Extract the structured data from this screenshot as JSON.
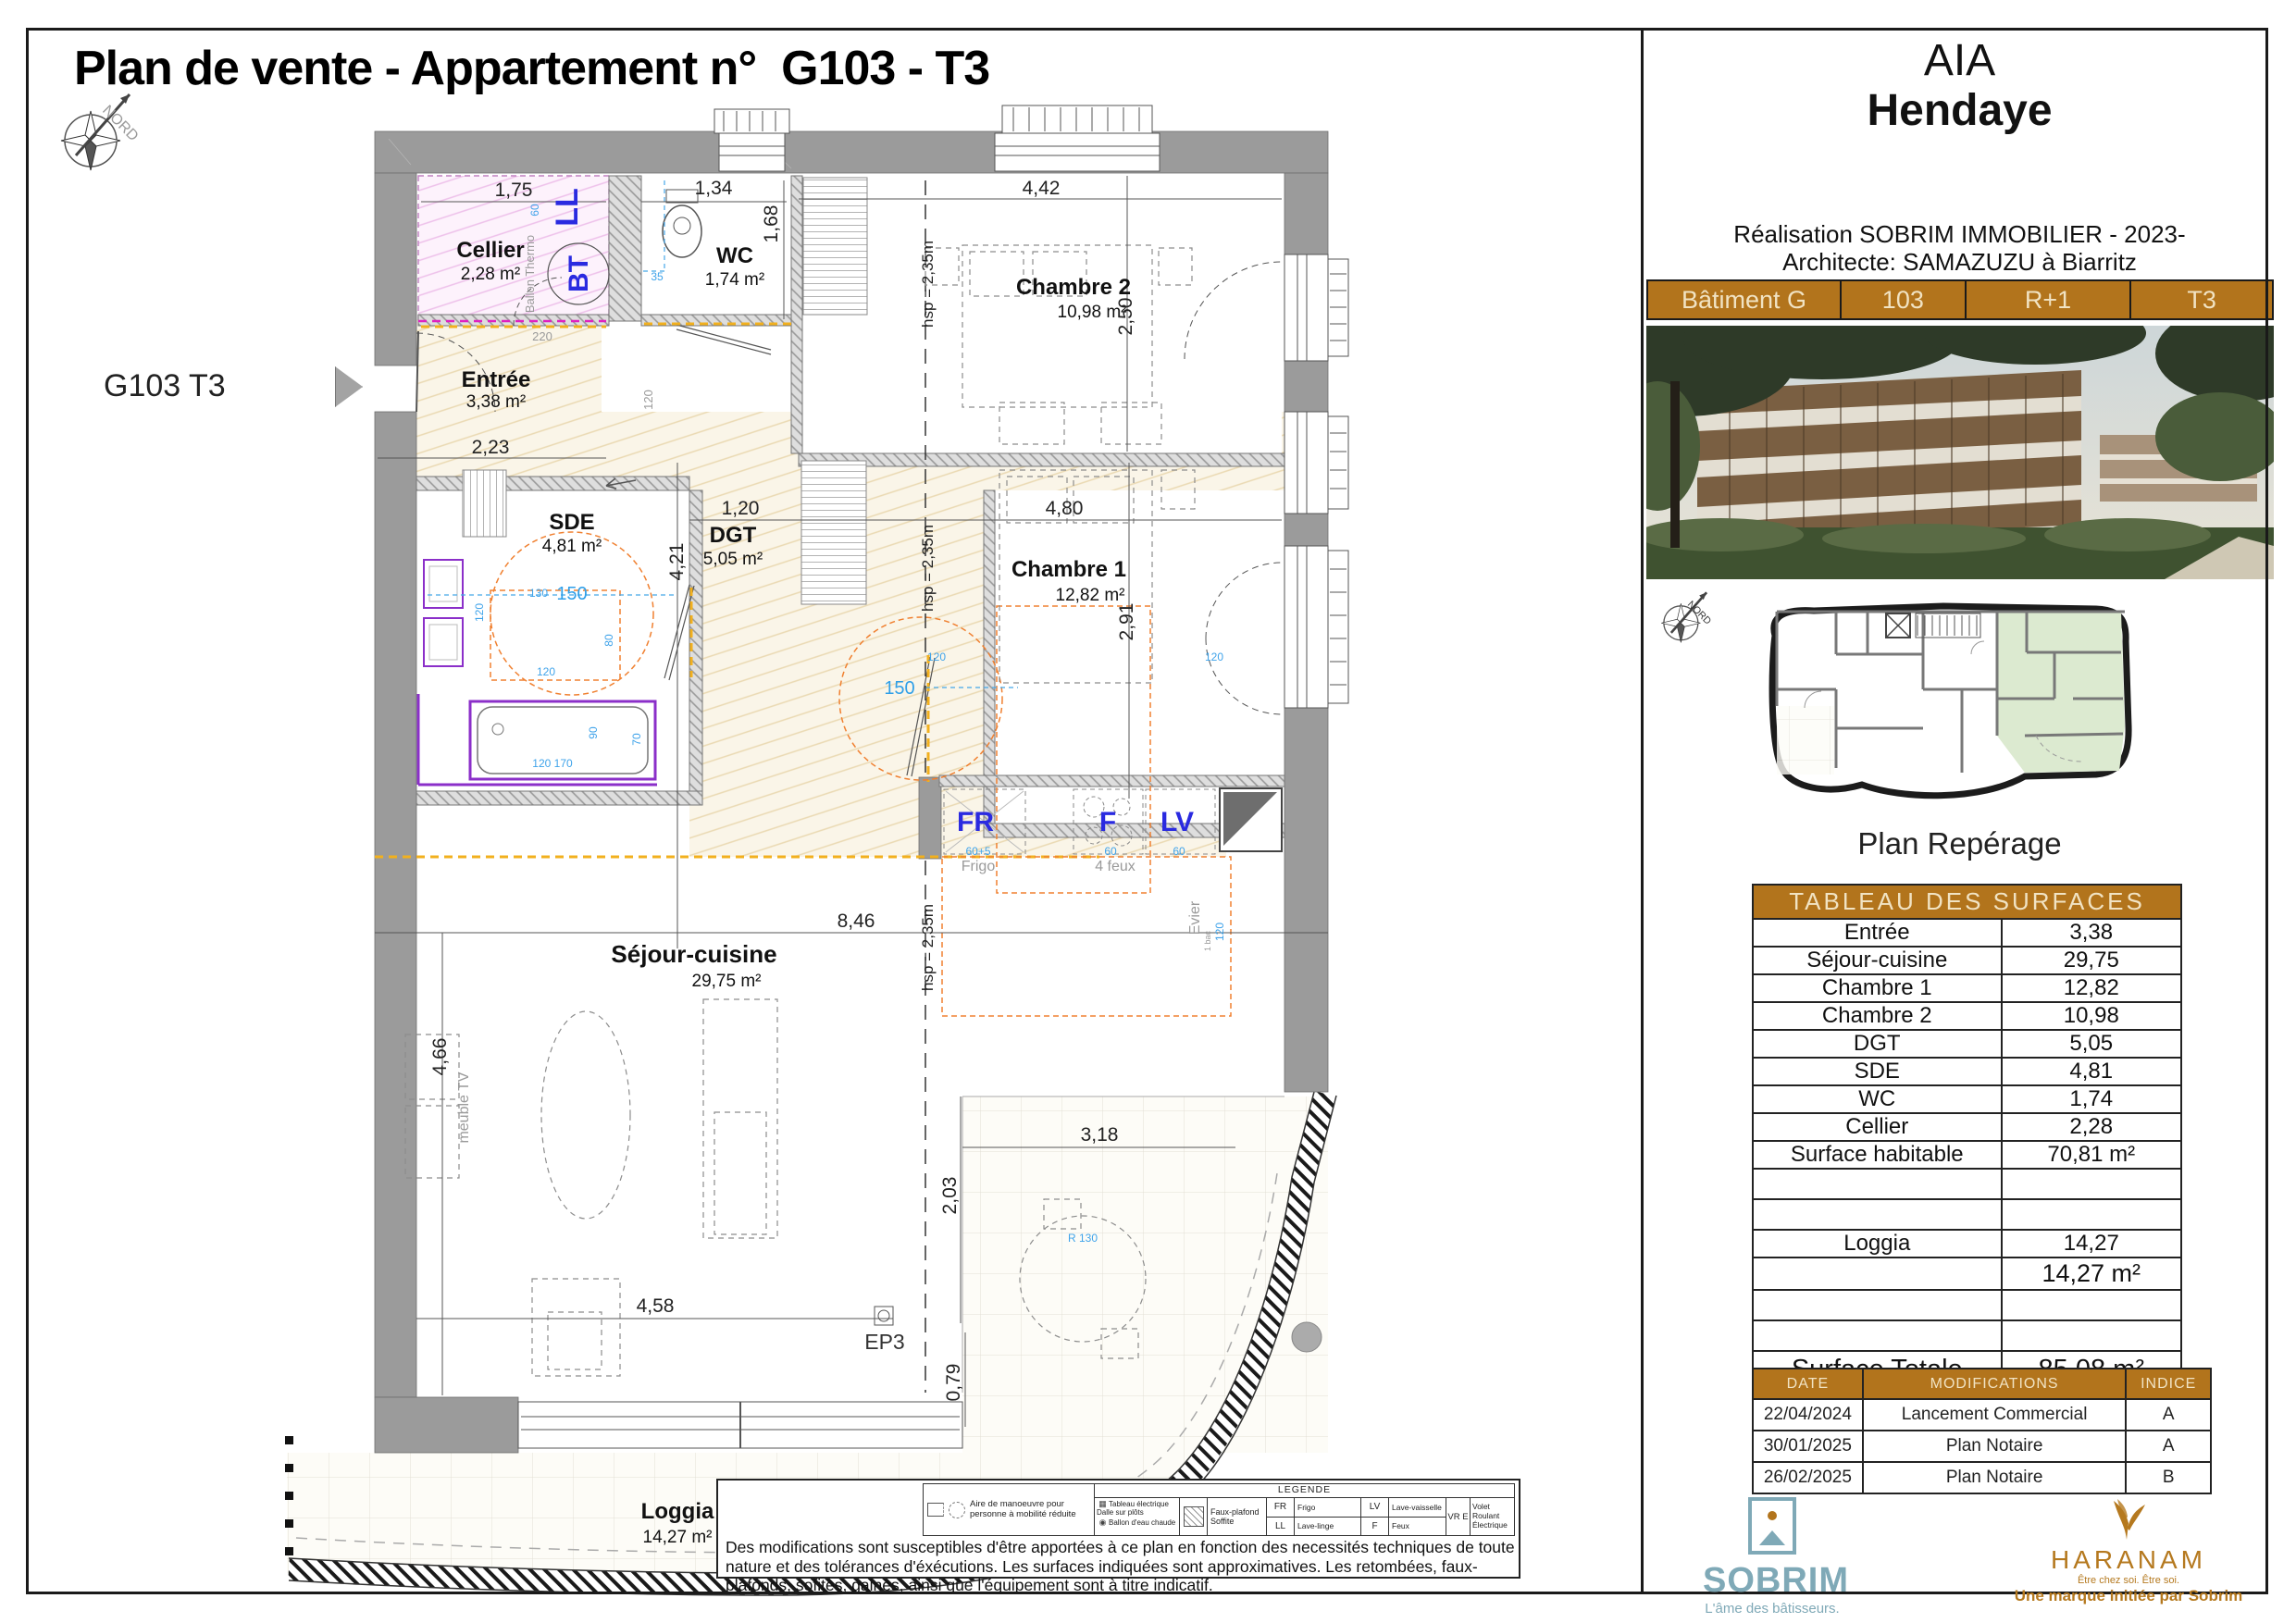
{
  "page": {
    "title": "Plan de vente - Appartement n°  G103 - T3",
    "unit_label": "G103 T3",
    "compass_label": "NORD"
  },
  "plan": {
    "rooms": {
      "cellier": {
        "name": "Cellier",
        "area": "2,28 m²"
      },
      "entree": {
        "name": "Entrée",
        "area": "3,38 m²"
      },
      "wc": {
        "name": "WC",
        "area": "1,74 m²"
      },
      "chambre2": {
        "name": "Chambre 2",
        "area": "10,98 m²"
      },
      "sde": {
        "name": "SDE",
        "area": "4,81 m²"
      },
      "dgt": {
        "name": "DGT",
        "area": "5,05 m²"
      },
      "chambre1": {
        "name": "Chambre 1",
        "area": "12,82 m²"
      },
      "sejour": {
        "name": "Séjour-cuisine",
        "area": "29,75 m²"
      },
      "loggia": {
        "name": "Loggia",
        "area": "14,27 m²"
      }
    },
    "dims": {
      "cellier_w": "1,75",
      "wc_w": "1,34",
      "wc_h": "1,68",
      "ch2_w": "4,42",
      "ch2_h": "2,50",
      "entree_w": "2,23",
      "dgt_w": "1,20",
      "sde_h": "4,21",
      "ch1_w": "4,80",
      "ch1_h": "2,91",
      "sejour_w": "8,46",
      "sejour_h": "4,66",
      "loggia_w": "4,58",
      "terr_w": "3,18",
      "terr_h": "2,03",
      "edge_h": "0,79"
    },
    "hsp": "hsp = 2,35m",
    "ep": "EP3",
    "blue": {
      "ll": "LL",
      "bt": "BT",
      "fr": "FR",
      "f": "F",
      "lv": "LV"
    },
    "cyan": {
      "n60": "60",
      "n35": "35",
      "n120": "120",
      "n130": "130",
      "n150": "150",
      "n80": "80",
      "n90": "90",
      "n70": "70",
      "n120170": "120 170",
      "n60p5": "60+5",
      "r130": "R 130"
    },
    "gray": {
      "frigo": "Frigo",
      "feux": "4 feux",
      "evier": "Evier",
      "bac": "1 bac",
      "meuble_tv": "meuble TV",
      "ballon": "Ballon Thermo",
      "n220": "220",
      "n120": "120"
    }
  },
  "legend": {
    "title": "LEGENDE",
    "aire": "Aire de manoeuvre pour personne à mobilité réduite",
    "tableau": "Tableau électrique",
    "dalle": "Dalle sur plôts",
    "ballon": "Ballon d'eau chaude",
    "faux_plafond": "Faux-plafond",
    "soffite": "Soffite",
    "fr": "FR",
    "frigo": "Frigo",
    "ll": "LL",
    "lave_linge": "Lave-linge",
    "lv": "LV",
    "lave_vaisselle": "Lave-vaisselle",
    "f": "F",
    "feux": "Feux",
    "vre": "VR E",
    "volet": "Volet Roulant Électrique",
    "disclaimer": "Des modifications sont susceptibles d'être apportées à ce plan en fonction des necessités techniques de toute nature et des tolérances d'éxécutions. Les surfaces indiquées sont approximatives. Les retombées, faux-plafonds, sofites, gaines, ainsi que l'équipement sont à titre indicatif."
  },
  "info": {
    "project": "AIA",
    "city": "Hendaye",
    "realisation": "Réalisation SOBRIM IMMOBILIER - 2023-",
    "architecte": "Architecte: SAMAZUZU à Biarritz",
    "building_bar": {
      "batiment": "Bâtiment G",
      "lot": "103",
      "etage": "R+1",
      "type": "T3"
    },
    "plan_reperage": "Plan Repérage",
    "surface_table": {
      "title": "TABLEAU DES SURFACES",
      "rows": [
        {
          "label": "Entrée",
          "value": "3,38"
        },
        {
          "label": "Séjour-cuisine",
          "value": "29,75"
        },
        {
          "label": "Chambre 1",
          "value": "12,82"
        },
        {
          "label": "Chambre 2",
          "value": "10,98"
        },
        {
          "label": "DGT",
          "value": "5,05"
        },
        {
          "label": "SDE",
          "value": "4,81"
        },
        {
          "label": "WC",
          "value": "1,74"
        },
        {
          "label": "Cellier",
          "value": "2,28"
        },
        {
          "label": "Surface habitable",
          "value": "70,81 m²"
        },
        {
          "label": "",
          "value": ""
        },
        {
          "label": "",
          "value": ""
        },
        {
          "label": "Loggia",
          "value": "14,27"
        },
        {
          "label": "",
          "value": "14,27 m²"
        },
        {
          "label": "",
          "value": ""
        },
        {
          "label": "",
          "value": ""
        },
        {
          "label": "Surface Totale",
          "value": "85,08 m²"
        }
      ]
    },
    "revision_table": {
      "headers": {
        "date": "DATE",
        "modifications": "MODIFICATIONS",
        "indice": "INDICE"
      },
      "rows": [
        {
          "date": "22/04/2024",
          "modification": "Lancement Commercial",
          "indice": "A"
        },
        {
          "date": "30/01/2025",
          "modification": "Plan Notaire",
          "indice": "A"
        },
        {
          "date": "26/02/2025",
          "modification": "Plan Notaire",
          "indice": "B"
        }
      ]
    },
    "sobrim": {
      "name": "SOBRIM",
      "tagline": "L'âme des bâtisseurs."
    },
    "haranam": {
      "name": "HARANAM",
      "tagline": "Être chez soi. Être soi.",
      "subline": "Une marque initiée par Sobrim"
    }
  },
  "colors": {
    "accent": "#b2741c",
    "sobrim_blue": "#7fa9b7",
    "haranam_gold": "#b5791f",
    "highlight_green": "#dcead0"
  }
}
